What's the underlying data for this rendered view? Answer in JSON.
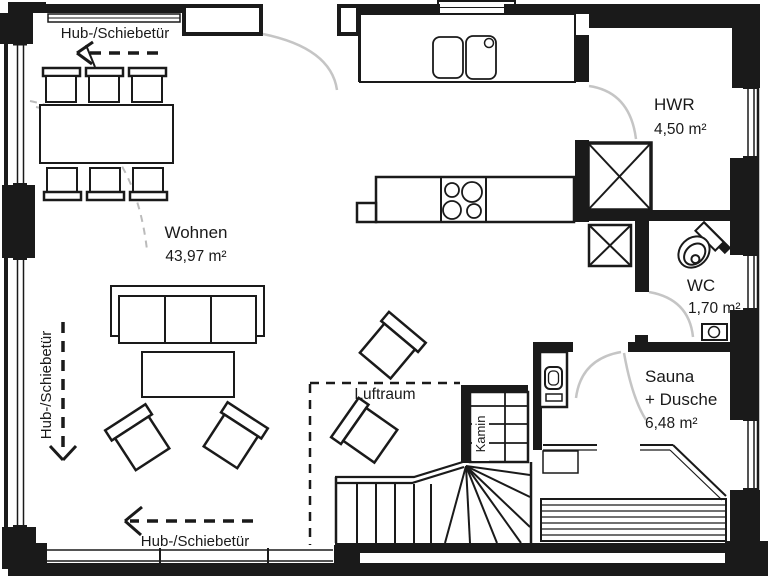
{
  "rooms": {
    "wohnen": {
      "label": "Wohnen",
      "area": "43,97 m²"
    },
    "hwr": {
      "label": "HWR",
      "area": "4,50 m²"
    },
    "wc": {
      "label": "WC",
      "area": "1,70 m²"
    },
    "sauna": {
      "label": "Sauna",
      "label2": "+ Dusche",
      "area": "6,48 m²"
    },
    "luftraum": {
      "label": "Luftraum"
    },
    "kamin": {
      "label": "Kamin"
    }
  },
  "annotations": {
    "sliding_door_top": "Hub-/Schiebetür",
    "sliding_door_left": "Hub-/Schiebetür",
    "sliding_door_bottom": "Hub-/Schiebetür"
  },
  "colors": {
    "walls": "#1a1a1a",
    "door_swings": "#c5c5c5",
    "dashed_guides": "#bbbbbb",
    "background": "#ffffff"
  },
  "symbols": [
    "dining-table",
    "dining-chair",
    "sofa",
    "coffee-table",
    "armchair",
    "kitchen-counter",
    "double-sink",
    "cooktop",
    "washing-machine",
    "duct-shaft",
    "toilet",
    "washbasin",
    "shower",
    "sauna-bench",
    "winder-stairs",
    "fireplace",
    "sliding-door-window",
    "door-swing-arc"
  ]
}
